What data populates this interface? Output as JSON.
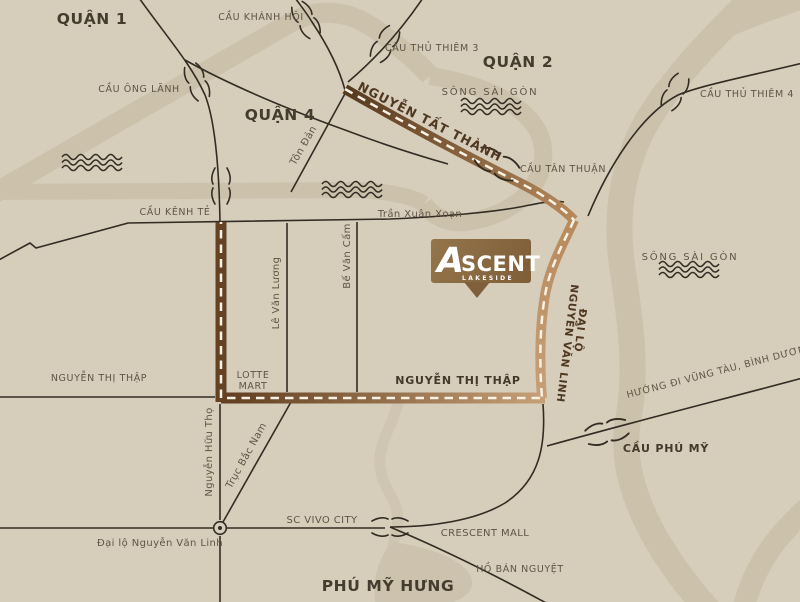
{
  "map": {
    "labels": {
      "quan1": "QUẬN 1",
      "quan2": "QUẬN 2",
      "quan4": "QUẬN 4",
      "phu_my_hung": "PHÚ MỸ HƯNG",
      "cau_khanh_hoi": "CẦU KHÁNH HỘI",
      "cau_thu_thiem_3": "CẦU THỦ THIÊM 3",
      "cau_thu_thiem_4": "CẦU THỦ THIÊM 4",
      "cau_ong_lanh": "CẦU ÔNG LÃNH",
      "cau_tan_thuan": "CẦU TÂN THUẬN",
      "cau_kenh_te": "CẦU KÊNH TẺ",
      "cau_phu_my": "CẦU PHÚ MỸ",
      "song_sai_gon": "SÔNG SÀI GÒN",
      "song_sai_gon_2": "SÔNG SÀI GÒN",
      "ho_ban_nguyet": "HỒ BÁN NGUYỆT",
      "nguyen_tat_thanh": "NGUYỄN TẤT THÀNH",
      "ton_dan": "Tôn Đản",
      "tran_xuan_xoan": "Trần Xuân Xoạn",
      "le_van_luong": "Lê Văn Lương",
      "be_van_cam": "Bế Văn Cấm",
      "dai_lo": "ĐẠI LỘ",
      "nguyen_van_linh": "NGUYỄN VĂN LINH",
      "nguyen_thi_thap_west": "NGUYỄN THỊ THẬP",
      "nguyen_thi_thap": "NGUYỄN THỊ THẬP",
      "lotte": "LOTTE",
      "mart": "MART",
      "nguyen_huu_tho": "Nguyễn Hữu Thọ",
      "truc_bac_nam": "Trục Bắc Nam",
      "sc_vivo_city": "SC VIVO CITY",
      "dai_lo_nguyen_van_linh": "Đại lộ Nguyễn Văn Linh",
      "crescent_mall": "CRESCENT MALL",
      "huong_di": "HƯỚNG ĐI VŨNG TÀU, BÌNH DƯƠNG"
    },
    "logo": {
      "initial": "A",
      "rest": "SCENT",
      "sub": "LAKESIDE"
    },
    "colors": {
      "background": "#d6cdbb",
      "waterway_band": "#ccc1ab",
      "faint_band": "#cfc5b1",
      "road_line": "#332c23",
      "label_text": "#5e5546",
      "district_text": "#443c2e",
      "route_dark": "#5a3b1f",
      "route_light": "#c49c74",
      "route_dash": "#f7f2e6",
      "logo_brown": "#8d6c42"
    }
  }
}
